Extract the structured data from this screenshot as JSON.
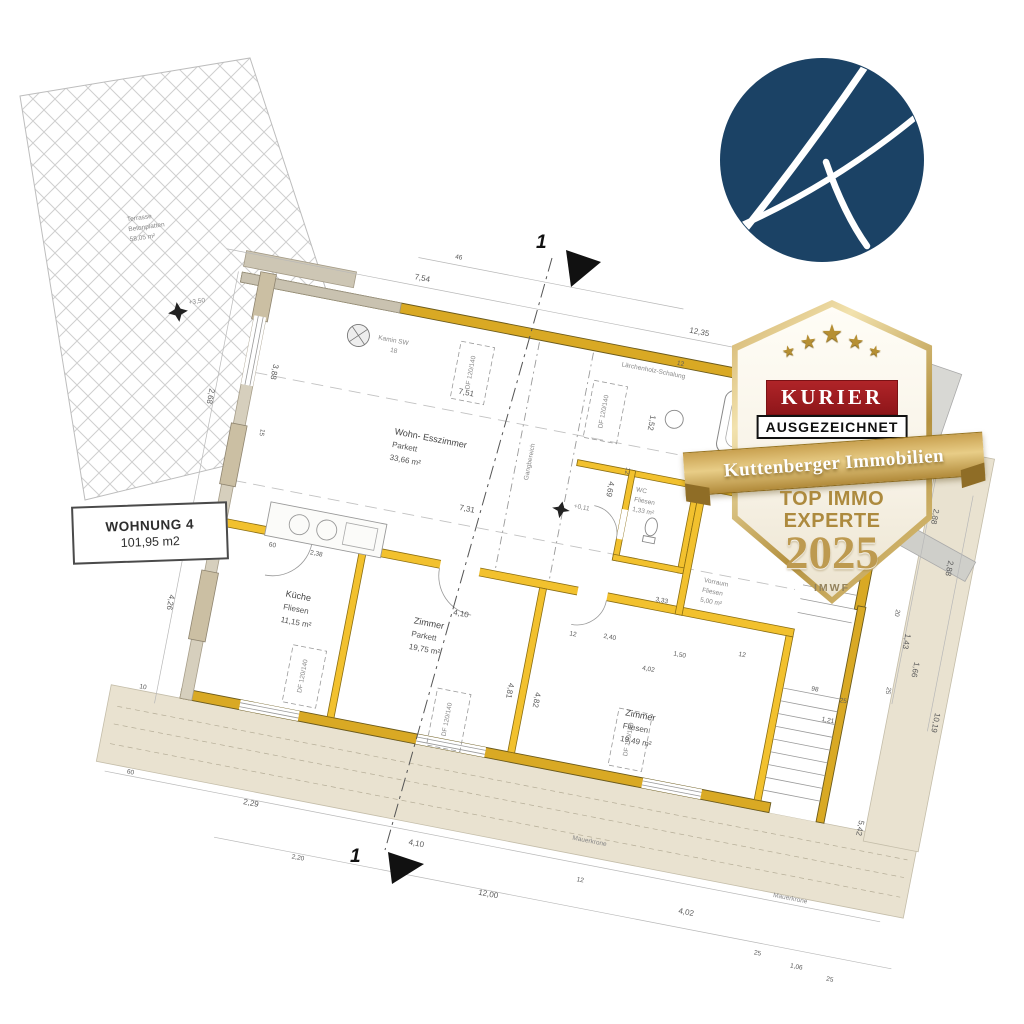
{
  "colors": {
    "wall_yellow": "#F2C12E",
    "wall_dark": "#D9A924",
    "logo_navy": "#1B4265",
    "badge_gold": "#C2A05A",
    "kurier_red": "#9E1B1E",
    "beige_band": "#E9E2D0"
  },
  "logo": {
    "name": "kuttenberger-k-logo"
  },
  "badge": {
    "kurier": "KURIER",
    "ausgezeichnet": "AUSGEZEICHNET",
    "ribbon": "Kuttenberger Immobilien",
    "line1": "TOP IMMO",
    "line2": "EXPERTE",
    "year": "2025",
    "source": "IMWF",
    "stars": "★"
  },
  "unit_box": {
    "line1": "WOHNUNG 4",
    "line2": "101,95 m2"
  },
  "terrace": {
    "line1": "Terrasse",
    "line2": "Betonplatten",
    "line3": "58,05 m²",
    "level": "+3,50"
  },
  "rooms": [
    {
      "name": "Wohn- Esszimmer",
      "floor": "Parkett",
      "area": "33,66 m²"
    },
    {
      "name": "Küche",
      "floor": "Fliesen",
      "area": "11,15 m²"
    },
    {
      "name": "Zimmer",
      "floor": "Parkett",
      "area": "19,75 m²"
    },
    {
      "name": "Zimmer",
      "floor": "Fliesen",
      "area": "19,49 m²"
    },
    {
      "name": "WC",
      "floor": "Fliesen",
      "area": "1,33 m²"
    },
    {
      "name": "Vorraum",
      "floor": "Fliesen",
      "area": "5,00 m²"
    }
  ],
  "section_markers": {
    "top": "1",
    "bottom": "1"
  },
  "notes": {
    "corridor": "Gangbereich",
    "corridor_level": "+0,11",
    "wall": "Lärchenholz-Schalung",
    "chimney1": "Kamin SW",
    "chimney2": "18",
    "crown1": "Mauerkrone",
    "crown2": "Mauerkrone"
  },
  "skylights": {
    "label": "DF 120/140",
    "positions": [
      [
        225,
        55
      ],
      [
        363,
        68
      ],
      [
        118,
        385
      ],
      [
        268,
        400
      ],
      [
        450,
        385
      ]
    ]
  },
  "dims": [
    {
      "t": "7,54",
      "x": 150,
      "y": -26
    },
    {
      "t": "12,35",
      "x": 430,
      "y": -26
    },
    {
      "t": "12",
      "x": 600,
      "y": -26,
      "s": 1
    },
    {
      "t": "46",
      "x": 186,
      "y": -54,
      "s": 1
    },
    {
      "t": "7,51",
      "x": 215,
      "y": 78
    },
    {
      "t": "1,52",
      "x": 408,
      "y": 62,
      "r": 90
    },
    {
      "t": "4,69",
      "x": 380,
      "y": 135,
      "r": 90
    },
    {
      "t": "12",
      "x": 424,
      "y": 8,
      "s": 1
    },
    {
      "t": "1,10",
      "x": 452,
      "y": 112,
      "s": 1
    },
    {
      "t": "10",
      "x": 482,
      "y": 116,
      "s": 1
    },
    {
      "t": "7,31",
      "x": 238,
      "y": 192
    },
    {
      "t": "3,33",
      "x": 448,
      "y": 244,
      "s": 1
    },
    {
      "t": "2,38",
      "x": 100,
      "y": 264,
      "s": 1
    },
    {
      "t": "60",
      "x": 58,
      "y": 264,
      "s": 1
    },
    {
      "t": "4,10",
      "x": 252,
      "y": 296
    },
    {
      "t": "2,40",
      "x": 404,
      "y": 290,
      "s": 1
    },
    {
      "t": "1,50",
      "x": 476,
      "y": 294,
      "s": 1
    },
    {
      "t": "4,02",
      "x": 448,
      "y": 314,
      "s": 1
    },
    {
      "t": "12",
      "x": 370,
      "y": 294,
      "s": 1
    },
    {
      "t": "12",
      "x": 540,
      "y": 282,
      "s": 1
    },
    {
      "t": "4,81",
      "x": 320,
      "y": 352,
      "r": 90
    },
    {
      "t": "4,82",
      "x": 348,
      "y": 356,
      "r": 90
    },
    {
      "t": "2,88",
      "x": 704,
      "y": 100,
      "r": 90
    },
    {
      "t": "2,88",
      "x": 728,
      "y": 148,
      "r": 90
    },
    {
      "t": "20",
      "x": 686,
      "y": 206,
      "r": 90,
      "s": 1
    },
    {
      "t": "1,43",
      "x": 700,
      "y": 228,
      "r": 90
    },
    {
      "t": "1,66",
      "x": 714,
      "y": 254,
      "r": 90
    },
    {
      "t": "25",
      "x": 692,
      "y": 284,
      "r": 90,
      "s": 1
    },
    {
      "t": "98",
      "x": 618,
      "y": 302,
      "s": 1
    },
    {
      "t": "25",
      "x": 648,
      "y": 308,
      "s": 1
    },
    {
      "t": "1,21",
      "x": 634,
      "y": 330,
      "s": 1
    },
    {
      "t": "10,19",
      "x": 744,
      "y": 300,
      "r": 90
    },
    {
      "t": "5,42",
      "x": 690,
      "y": 420,
      "r": 90
    },
    {
      "t": "60",
      "x": -38,
      "y": 514,
      "s": 1
    },
    {
      "t": "2,29",
      "x": 82,
      "y": 522
    },
    {
      "t": "2,20",
      "x": 140,
      "y": 566,
      "s": 1
    },
    {
      "t": "4,10",
      "x": 252,
      "y": 530
    },
    {
      "t": "12",
      "x": 424,
      "y": 534,
      "s": 1
    },
    {
      "t": "12,00",
      "x": 330,
      "y": 566
    },
    {
      "t": "4,02",
      "x": 530,
      "y": 546
    },
    {
      "t": "25",
      "x": 612,
      "y": 572,
      "s": 1
    },
    {
      "t": "1,06",
      "x": 650,
      "y": 578,
      "s": 1
    },
    {
      "t": "25",
      "x": 688,
      "y": 584,
      "s": 1
    },
    {
      "t": "4,26",
      "x": -30,
      "y": 330,
      "r": 90
    },
    {
      "t": "2,68",
      "x": -30,
      "y": 120,
      "r": 90
    },
    {
      "t": "3,88",
      "x": 28,
      "y": 84,
      "r": 90
    },
    {
      "t": "15",
      "x": 28,
      "y": 150,
      "r": 90,
      "s": 1
    },
    {
      "t": "10",
      "x": -42,
      "y": 428,
      "s": 1
    },
    {
      "t": "12",
      "x": 394,
      "y": 118,
      "r": 90,
      "s": 1
    }
  ]
}
